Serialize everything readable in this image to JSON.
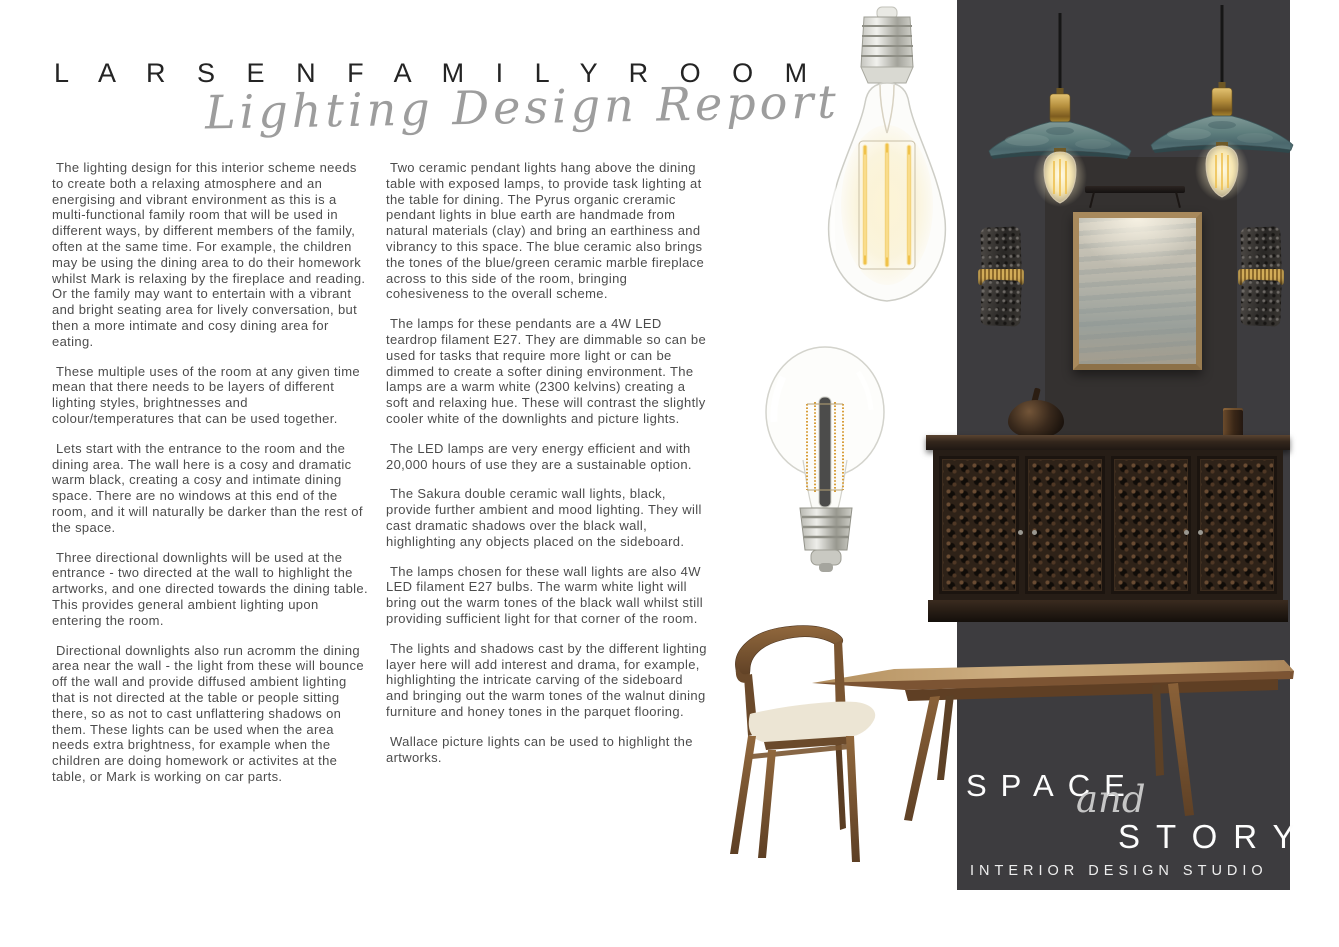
{
  "page": {
    "title": "L A R S E N   F A M I L Y   R O O M",
    "subtitle": "Lighting Design Report"
  },
  "columns": {
    "left": {
      "paragraphs": [
        "The lighting design for this interior scheme needs to create both a relaxing atmosphere and an energising and vibrant environment as this is a multi-functional family room that will be used in different ways, by different members of the family, often at the same time. For example, the children may be using the dining area to do their homework whilst Mark is relaxing by the fireplace and reading. Or the family may want to entertain with a vibrant and bright seating area for lively conversation, but then a more intimate and cosy dining area for eating.",
        "These multiple uses of the room at any given time mean that there needs to be layers of different lighting styles, brightnesses and colour/temperatures that can be used together.",
        "Lets start with the entrance to the room and the dining area. The wall here is a cosy and dramatic warm black, creating a cosy and intimate dining space. There are no windows at this end of the room, and it will naturally be darker than the rest of the space.",
        "Three directional downlights will be used at the entrance - two directed at the wall to highlight the artworks, and one directed towards the dining table. This provides general ambient lighting upon entering the room.",
        "Directional downlights also run acromm the dining area near the wall - the light from these will bounce off the wall and provide diffused ambient lighting that is not directed at the table or people sitting there, so as not to cast unflattering shadows on them. These lights can be used when the area needs extra brightness, for example when the children are doing homework or activites at the table, or Mark is working on car parts."
      ]
    },
    "middle": {
      "paragraphs": [
        "Two ceramic pendant lights hang above the dining table with exposed lamps, to provide task lighting at the table for dining. The Pyrus organic creramic pendant lights in blue earth are handmade from natural materials (clay) and bring an earthiness and vibrancy to this space. The blue ceramic also brings the tones of the blue/green ceramic marble fireplace across to this side of the room, bringing cohesiveness to the overall scheme.",
        "The lamps for these pendants are a 4W LED teardrop filament E27. They are dimmable so can be used for tasks that require more light or can be dimmed to create a softer dining environment. The lamps are a warm white (2300 kelvins) creating a soft and relaxing hue. These will contrast the slightly cooler white of the downlights and picture lights.",
        "The LED lamps are very energy efficient and with 20,000 hours of use they are a sustainable option.",
        "The Sakura double ceramic wall lights, black, provide further ambient and mood lighting. They will cast dramatic shadows over the black wall, highlighting any objects placed on the sideboard.",
        "The lamps chosen for these wall lights are also 4W LED filament E27 bulbs. The warm white light will bring out the warm tones of the black wall whilst still providing sufficient light for that corner of the room.",
        "The lights and shadows cast by the different lighting layer here will add interest and drama, for example, highlighting the intricate carving of the sideboard and bringing out the warm tones of the walnut dining furniture and honey tones in the parquet flooring.",
        "Wallace picture lights can be used to highlight the artworks."
      ]
    }
  },
  "brand": {
    "line1": "SPACE",
    "line2": "and",
    "line3": "STORY",
    "tagline": "INTERIOR DESIGN STUDIO"
  },
  "colors": {
    "panel_bg": "#3d3c3f",
    "backdrop_bg": "#343130",
    "pendant_shade_teal": "#5d7b7e",
    "brass": "#c2a04e",
    "walnut_wood": "#8a6138",
    "seat_cream": "#ece4d2",
    "body_text": "#4c4c4c",
    "script_gray": "#9d9d9d",
    "brand_text": "#fdfdfd"
  }
}
